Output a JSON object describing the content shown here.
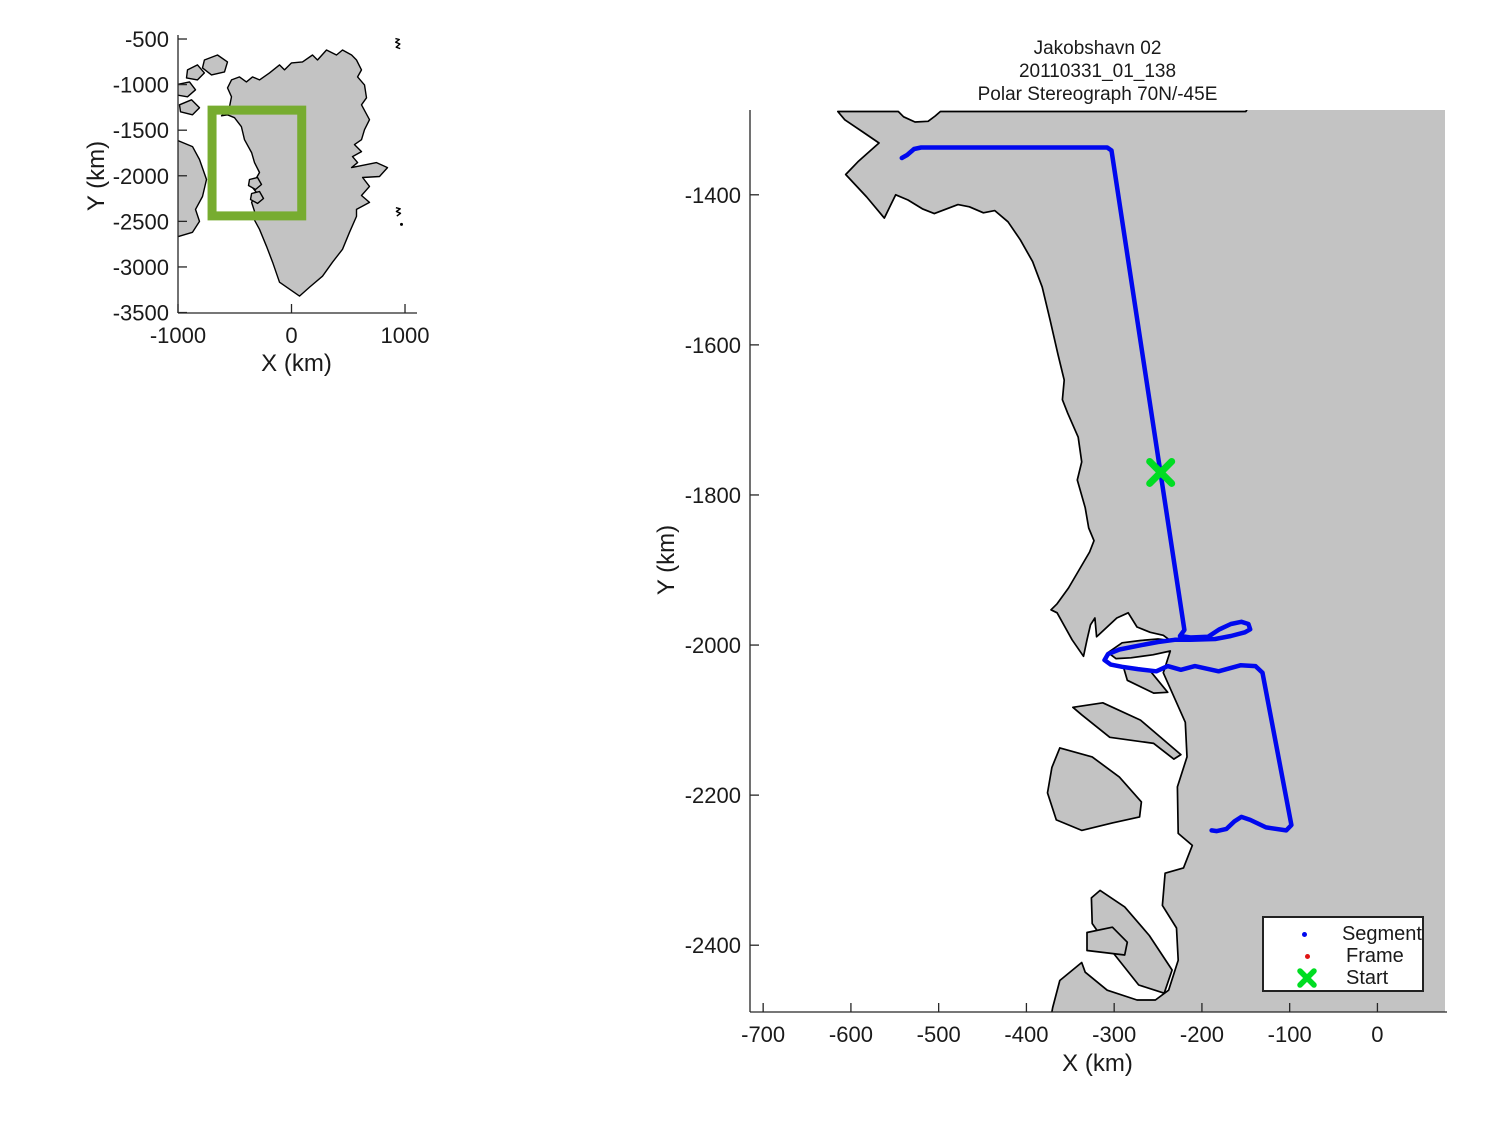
{
  "colors": {
    "land": "#c3c3c3",
    "coast": "#000000",
    "segment": "#0008ee",
    "frame": "#e01414",
    "start": "#00dd22",
    "coverage_box": "#77ac30",
    "axis": "#262626",
    "text": "#1a1a1a",
    "background": "#ffffff"
  },
  "chart_data": [
    {
      "type": "map",
      "role": "overview-inset",
      "xlabel": "X (km)",
      "ylabel": "Y (km)",
      "xticks": [
        -1000,
        0,
        1000
      ],
      "yticks": [
        -500,
        -1000,
        -1500,
        -2000,
        -2500,
        -3000,
        -3500
      ],
      "xlim": [
        -1000,
        1088
      ],
      "ylim": [
        -3505,
        -456
      ],
      "grid": false,
      "rect": {
        "left": 178,
        "top": 35,
        "right": 415,
        "bottom": 313
      },
      "coverage_box": {
        "x0": -700,
        "x1": 90,
        "y0": -1280,
        "y1": -2440,
        "stroke_width": 9
      },
      "land": [
        [
          [
            -564,
            -1036
          ],
          [
            -529,
            -948
          ],
          [
            -458,
            -915
          ],
          [
            -397,
            -970
          ],
          [
            -344,
            -915
          ],
          [
            -282,
            -948
          ],
          [
            -194,
            -872
          ],
          [
            -106,
            -784
          ],
          [
            -62,
            -839
          ],
          [
            0,
            -762
          ],
          [
            97,
            -751
          ],
          [
            185,
            -675
          ],
          [
            229,
            -730
          ],
          [
            308,
            -620
          ],
          [
            396,
            -675
          ],
          [
            449,
            -620
          ],
          [
            529,
            -675
          ],
          [
            573,
            -730
          ],
          [
            617,
            -839
          ],
          [
            582,
            -915
          ],
          [
            643,
            -1003
          ],
          [
            661,
            -1145
          ],
          [
            617,
            -1221
          ],
          [
            687,
            -1385
          ],
          [
            643,
            -1495
          ],
          [
            617,
            -1604
          ],
          [
            555,
            -1658
          ],
          [
            617,
            -1735
          ],
          [
            537,
            -1790
          ],
          [
            582,
            -1855
          ],
          [
            529,
            -1910
          ],
          [
            749,
            -1855
          ],
          [
            846,
            -1910
          ],
          [
            775,
            -2008
          ],
          [
            626,
            -2019
          ],
          [
            687,
            -2117
          ],
          [
            617,
            -2216
          ],
          [
            687,
            -2292
          ],
          [
            573,
            -2369
          ],
          [
            573,
            -2445
          ],
          [
            511,
            -2620
          ],
          [
            449,
            -2806
          ],
          [
            361,
            -2948
          ],
          [
            273,
            -3101
          ],
          [
            159,
            -3221
          ],
          [
            70,
            -3320
          ],
          [
            -106,
            -3167
          ],
          [
            -167,
            -2948
          ],
          [
            -220,
            -2773
          ],
          [
            -282,
            -2587
          ],
          [
            -344,
            -2445
          ],
          [
            -326,
            -2390
          ],
          [
            -352,
            -2292
          ],
          [
            -308,
            -2183
          ],
          [
            -352,
            -2117
          ],
          [
            -282,
            -1964
          ],
          [
            -326,
            -1855
          ],
          [
            -352,
            -1746
          ],
          [
            -414,
            -1604
          ],
          [
            -441,
            -1462
          ],
          [
            -502,
            -1363
          ],
          [
            -564,
            -1331
          ],
          [
            -617,
            -1342
          ],
          [
            -546,
            -1243
          ],
          [
            -529,
            -1134
          ]
        ],
        [
          [
            -767,
            -730
          ],
          [
            -652,
            -675
          ],
          [
            -564,
            -751
          ],
          [
            -590,
            -861
          ],
          [
            -705,
            -894
          ],
          [
            -784,
            -817
          ]
        ],
        [
          [
            -916,
            -839
          ],
          [
            -828,
            -784
          ],
          [
            -767,
            -872
          ],
          [
            -828,
            -948
          ],
          [
            -925,
            -926
          ]
        ],
        [
          [
            -1020,
            -1003
          ],
          [
            -899,
            -970
          ],
          [
            -846,
            -1057
          ],
          [
            -916,
            -1134
          ],
          [
            -1020,
            -1112
          ]
        ],
        [
          [
            -987,
            -1221
          ],
          [
            -881,
            -1167
          ],
          [
            -811,
            -1254
          ],
          [
            -872,
            -1331
          ],
          [
            -978,
            -1298
          ]
        ],
        [
          [
            -1020,
            -1604
          ],
          [
            -872,
            -1680
          ],
          [
            -811,
            -1822
          ],
          [
            -749,
            -2041
          ],
          [
            -784,
            -2227
          ],
          [
            -846,
            -2369
          ],
          [
            -811,
            -2500
          ],
          [
            -872,
            -2620
          ],
          [
            -1020,
            -2675
          ]
        ],
        [
          [
            -370,
            -2041
          ],
          [
            -300,
            -2019
          ],
          [
            -264,
            -2096
          ],
          [
            -317,
            -2151
          ],
          [
            -379,
            -2107
          ]
        ],
        [
          [
            -352,
            -2194
          ],
          [
            -282,
            -2172
          ],
          [
            -247,
            -2249
          ],
          [
            -300,
            -2303
          ],
          [
            -361,
            -2260
          ]
        ]
      ],
      "scribbles": [
        [
          [
            915,
            -495
          ],
          [
            950,
            -505
          ],
          [
            918,
            -535
          ],
          [
            955,
            -555
          ],
          [
            922,
            -590
          ],
          [
            958,
            -605
          ]
        ],
        [
          [
            920,
            -2350
          ],
          [
            958,
            -2362
          ],
          [
            924,
            -2392
          ],
          [
            960,
            -2412
          ],
          [
            928,
            -2442
          ]
        ],
        [
          [
            969,
            -2533
          ]
        ]
      ]
    },
    {
      "type": "line",
      "role": "flight-track-map",
      "title_lines": [
        "Jakobshavn 02",
        "20110331_01_138",
        "Polar Stereograph 70N/-45E"
      ],
      "xlabel": "X (km)",
      "ylabel": "Y (km)",
      "xticks": [
        -700,
        -600,
        -500,
        -400,
        -300,
        -200,
        -100,
        0
      ],
      "yticks": [
        -1400,
        -1600,
        -1800,
        -2000,
        -2200,
        -2400
      ],
      "xlim": [
        -715,
        77
      ],
      "ylim": [
        -2489,
        -1287
      ],
      "grid": false,
      "rect": {
        "left": 750,
        "top": 110,
        "right": 1445,
        "bottom": 1012
      },
      "land": [
        [
          [
            -615,
            -1289
          ],
          [
            -607,
            -1300
          ],
          [
            -588,
            -1315
          ],
          [
            -568,
            -1331
          ],
          [
            -592,
            -1356
          ],
          [
            -606,
            -1373
          ],
          [
            -582,
            -1403
          ],
          [
            -562,
            -1431
          ],
          [
            -549,
            -1400
          ],
          [
            -535,
            -1407
          ],
          [
            -518,
            -1419
          ],
          [
            -505,
            -1425
          ],
          [
            -478,
            -1413
          ],
          [
            -465,
            -1416
          ],
          [
            -449,
            -1424
          ],
          [
            -436,
            -1421
          ],
          [
            -421,
            -1436
          ],
          [
            -407,
            -1460
          ],
          [
            -393,
            -1489
          ],
          [
            -382,
            -1523
          ],
          [
            -373,
            -1567
          ],
          [
            -364,
            -1613
          ],
          [
            -357,
            -1647
          ],
          [
            -359,
            -1673
          ],
          [
            -353,
            -1691
          ],
          [
            -341,
            -1723
          ],
          [
            -337,
            -1756
          ],
          [
            -342,
            -1780
          ],
          [
            -333,
            -1817
          ],
          [
            -329,
            -1844
          ],
          [
            -323,
            -1861
          ],
          [
            -328,
            -1876
          ],
          [
            -352,
            -1924
          ],
          [
            -365,
            -1945
          ],
          [
            -372,
            -1953
          ],
          [
            -365,
            -1957
          ],
          [
            -348,
            -1993
          ],
          [
            -335,
            -2015
          ],
          [
            -331,
            -1993
          ],
          [
            -327,
            -1973
          ],
          [
            -322,
            -1964
          ],
          [
            -320,
            -1989
          ],
          [
            -297,
            -1964
          ],
          [
            -284,
            -1957
          ],
          [
            -274,
            -1976
          ],
          [
            -259,
            -1983
          ],
          [
            -244,
            -1987
          ],
          [
            -236,
            -1994
          ],
          [
            -250,
            -1992
          ],
          [
            -270,
            -1994
          ],
          [
            -291,
            -1997
          ],
          [
            -307,
            -2010
          ],
          [
            -298,
            -2018
          ],
          [
            -281,
            -2017
          ],
          [
            -256,
            -2013
          ],
          [
            -236,
            -2008
          ],
          [
            -244,
            -2037
          ],
          [
            -219,
            -2103
          ],
          [
            -217,
            -2149
          ],
          [
            -228,
            -2189
          ],
          [
            -227,
            -2251
          ],
          [
            -211,
            -2267
          ],
          [
            -221,
            -2297
          ],
          [
            -242,
            -2304
          ],
          [
            -245,
            -2347
          ],
          [
            -229,
            -2377
          ],
          [
            -227,
            -2420
          ],
          [
            -238,
            -2460
          ],
          [
            -253,
            -2473
          ],
          [
            -274,
            -2473
          ],
          [
            -308,
            -2460
          ],
          [
            -333,
            -2436
          ],
          [
            -337,
            -2423
          ],
          [
            -362,
            -2447
          ],
          [
            -370,
            -2483
          ],
          [
            -376,
            -2520
          ],
          [
            130,
            -2520
          ],
          [
            130,
            -1270
          ],
          [
            -140,
            -1270
          ],
          [
            -150,
            -1289
          ],
          [
            -498,
            -1289
          ],
          [
            -504,
            -1295
          ],
          [
            -512,
            -1302
          ],
          [
            -527,
            -1303
          ],
          [
            -540,
            -1296
          ],
          [
            -546,
            -1289
          ]
        ],
        [
          [
            -347,
            -2083
          ],
          [
            -313,
            -2077
          ],
          [
            -270,
            -2100
          ],
          [
            -224,
            -2146
          ],
          [
            -232,
            -2152
          ],
          [
            -255,
            -2131
          ],
          [
            -305,
            -2123
          ],
          [
            -337,
            -2093
          ]
        ],
        [
          [
            -362,
            -2137
          ],
          [
            -325,
            -2149
          ],
          [
            -294,
            -2176
          ],
          [
            -269,
            -2209
          ],
          [
            -271,
            -2229
          ],
          [
            -302,
            -2237
          ],
          [
            -337,
            -2247
          ],
          [
            -366,
            -2233
          ],
          [
            -376,
            -2197
          ],
          [
            -371,
            -2163
          ]
        ],
        [
          [
            -316,
            -2327
          ],
          [
            -288,
            -2349
          ],
          [
            -260,
            -2387
          ],
          [
            -234,
            -2433
          ],
          [
            -243,
            -2464
          ],
          [
            -272,
            -2453
          ],
          [
            -306,
            -2403
          ],
          [
            -325,
            -2371
          ],
          [
            -326,
            -2337
          ]
        ],
        [
          [
            -331,
            -2383
          ],
          [
            -302,
            -2376
          ],
          [
            -285,
            -2396
          ],
          [
            -288,
            -2413
          ],
          [
            -331,
            -2407
          ]
        ],
        [
          [
            -289,
            -2031
          ],
          [
            -260,
            -2033
          ],
          [
            -239,
            -2063
          ],
          [
            -255,
            -2064
          ],
          [
            -285,
            -2047
          ]
        ]
      ],
      "track": [
        [
          -542,
          -1351
        ],
        [
          -536,
          -1347
        ],
        [
          -528,
          -1339
        ],
        [
          -520,
          -1337
        ],
        [
          -308,
          -1337
        ],
        [
          -303,
          -1341
        ],
        [
          -220,
          -1980
        ],
        [
          -225,
          -1988
        ],
        [
          -213,
          -1990
        ],
        [
          -193,
          -1989
        ],
        [
          -180,
          -1979
        ],
        [
          -167,
          -1972
        ],
        [
          -155,
          -1969
        ],
        [
          -147,
          -1972
        ],
        [
          -145,
          -1979
        ],
        [
          -151,
          -1983
        ],
        [
          -167,
          -1988
        ],
        [
          -185,
          -1992
        ],
        [
          -213,
          -1993
        ],
        [
          -231,
          -1993
        ],
        [
          -250,
          -1996
        ],
        [
          -273,
          -2001
        ],
        [
          -294,
          -2006
        ],
        [
          -307,
          -2012
        ],
        [
          -311,
          -2020
        ],
        [
          -304,
          -2026
        ],
        [
          -291,
          -2029
        ],
        [
          -273,
          -2032
        ],
        [
          -252,
          -2035
        ],
        [
          -239,
          -2028
        ],
        [
          -224,
          -2033
        ],
        [
          -208,
          -2028
        ],
        [
          -181,
          -2035
        ],
        [
          -156,
          -2027
        ],
        [
          -139,
          -2028
        ],
        [
          -131,
          -2037
        ],
        [
          -98,
          -2240
        ],
        [
          -104,
          -2247
        ],
        [
          -127,
          -2243
        ],
        [
          -145,
          -2233
        ],
        [
          -155,
          -2229
        ],
        [
          -163,
          -2235
        ],
        [
          -172,
          -2245
        ],
        [
          -183,
          -2248
        ],
        [
          -189,
          -2247
        ]
      ],
      "track_width": 4.5,
      "start_marker": {
        "x": -247,
        "y": -1770,
        "size": 22,
        "stroke_width": 7
      },
      "legend": {
        "items": [
          {
            "label": "Segment",
            "marker": "dot",
            "color_key": "segment"
          },
          {
            "label": "Frame",
            "marker": "dot",
            "color_key": "frame"
          },
          {
            "label": "Start",
            "marker": "cross",
            "color_key": "start"
          }
        ]
      }
    }
  ]
}
